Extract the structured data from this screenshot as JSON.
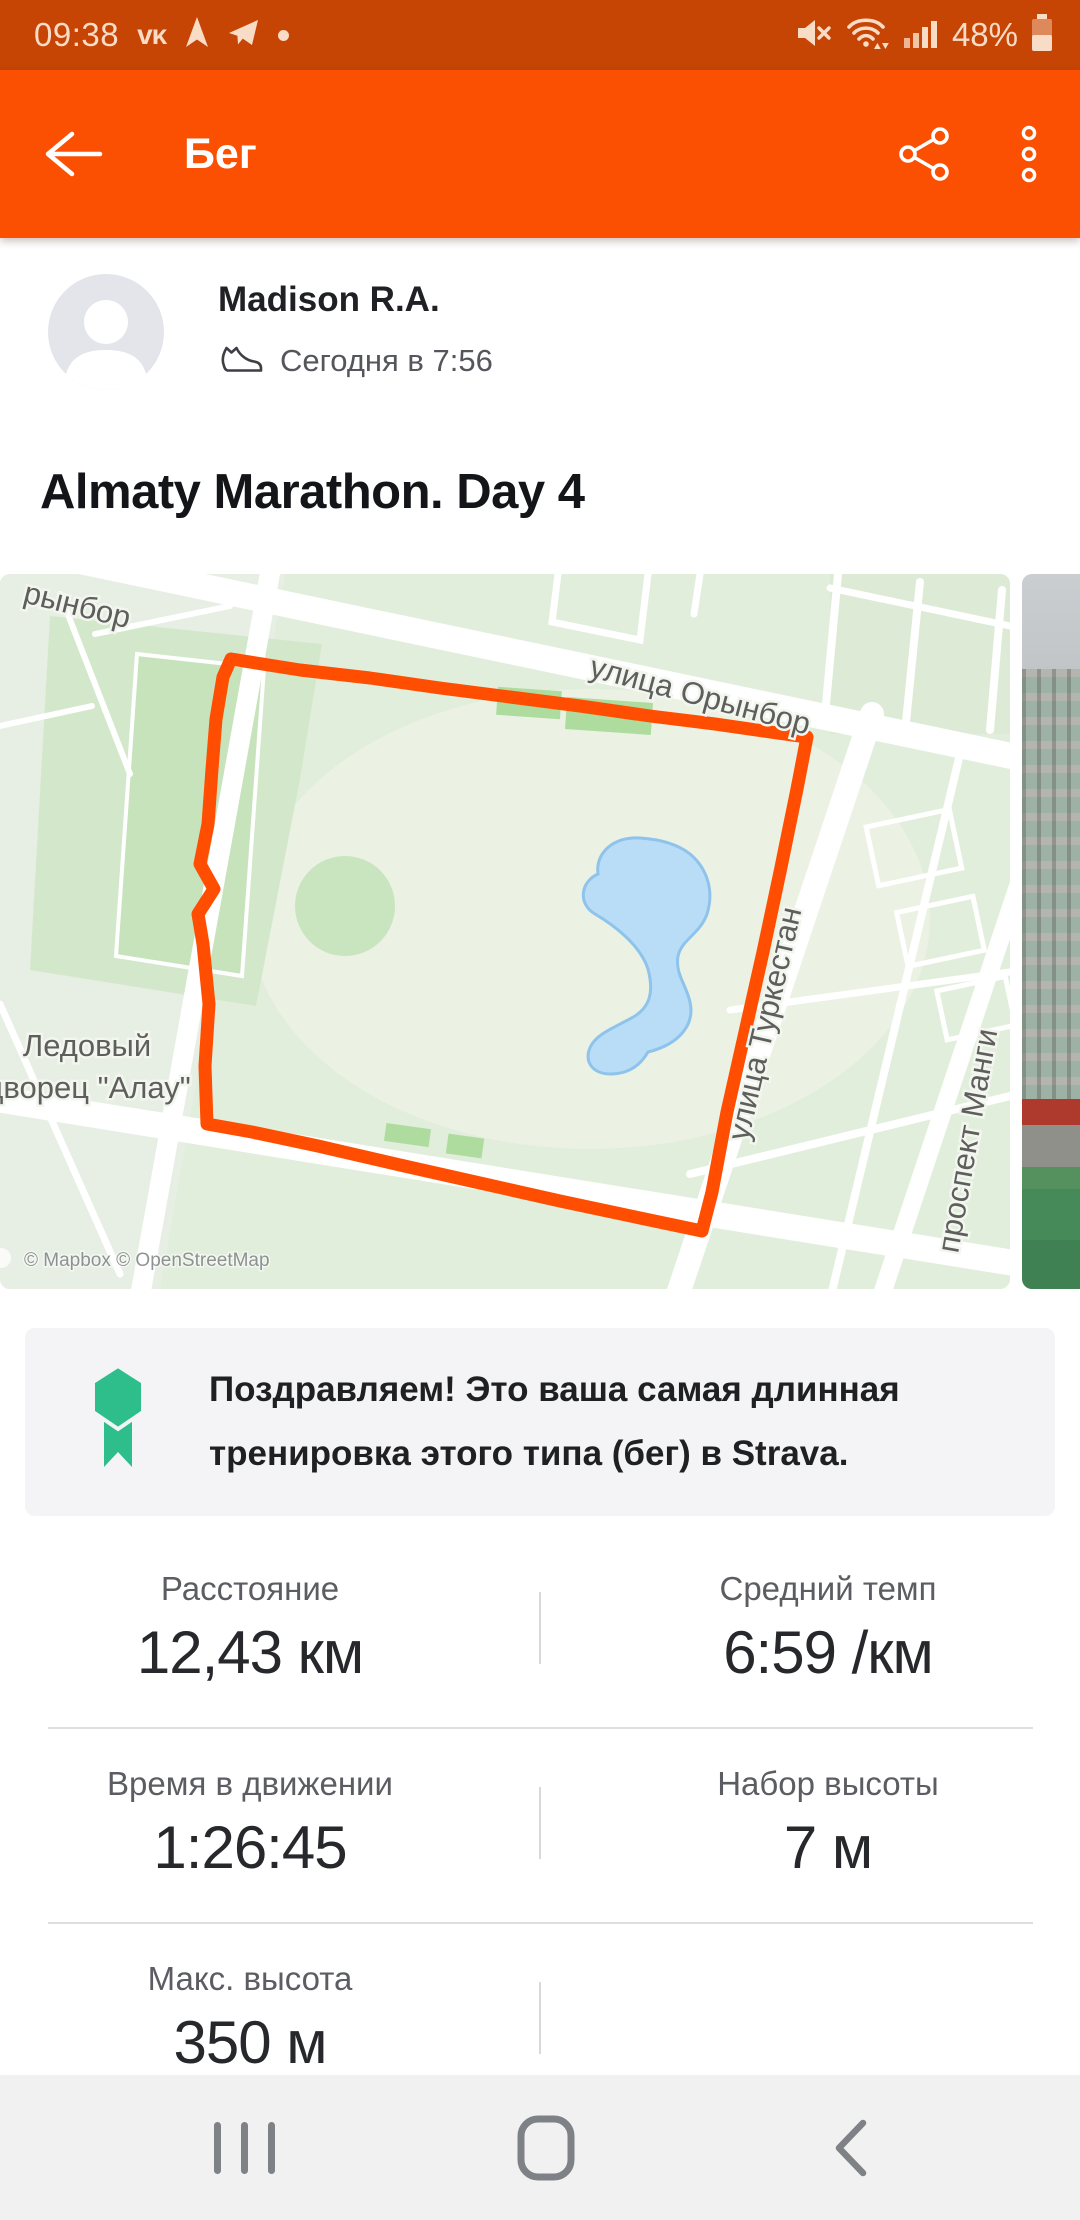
{
  "status_bar": {
    "time": "09:38",
    "battery_percent": "48%"
  },
  "app_bar": {
    "title": "Бег"
  },
  "activity": {
    "author": "Madison R.A.",
    "timestamp": "Сегодня в 7:56",
    "title": "Almaty Marathon. Day 4"
  },
  "map": {
    "labels": {
      "street_partial": "рынбор",
      "street_orynbor": "улица Орынбор",
      "street_turkestan": "улица Туркестан",
      "street_mangilik": "проспект Манги",
      "poi_line1": "Ледовый",
      "poi_line2": "дворец \"Алау\"",
      "attribution": "© Mapbox © OpenStreetMap"
    },
    "route_color": "#FF4E01"
  },
  "achievement": {
    "message": "Поздравляем! Это ваша самая длинная тренировка этого типа (бег) в Strava."
  },
  "stats": {
    "rows": [
      [
        {
          "label": "Расстояние",
          "value": "12,43 км"
        },
        {
          "label": "Средний темп",
          "value": "6:59 /км"
        }
      ],
      [
        {
          "label": "Время в движении",
          "value": "1:26:45"
        },
        {
          "label": "Набор высоты",
          "value": "7 м"
        }
      ],
      [
        {
          "label": "Макс. высота",
          "value": "350 м"
        },
        {
          "label": "",
          "value": ""
        }
      ]
    ]
  },
  "colors": {
    "app_bar_orange": "#FB5002",
    "status_bar_orange": "#C64505",
    "achievement_green": "#2EBE8C",
    "route_orange": "#FF4E01",
    "map_green": "#E2EEDC",
    "water_blue": "#B9DDF6"
  }
}
